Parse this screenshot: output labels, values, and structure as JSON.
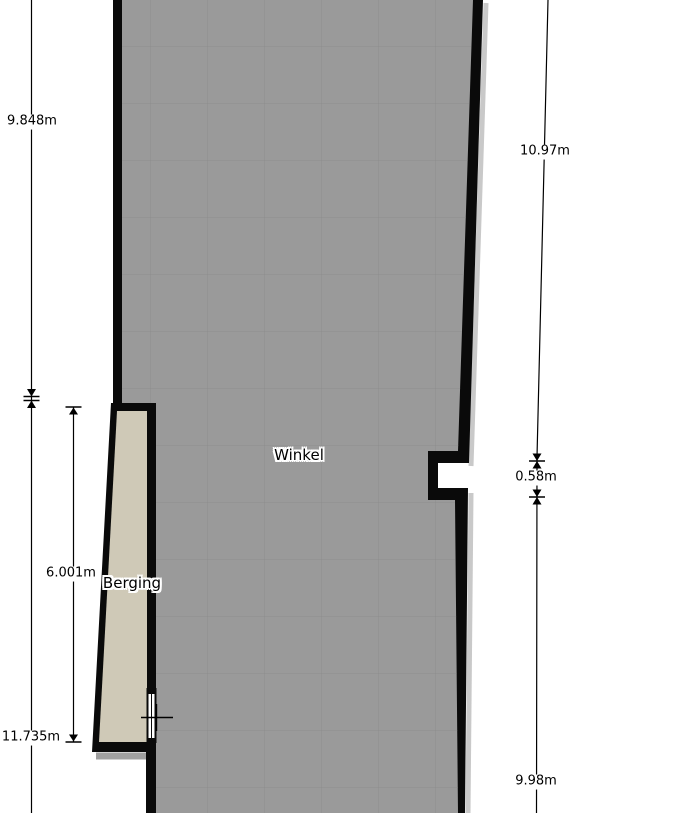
{
  "rooms": {
    "winkel": {
      "label": "Winkel"
    },
    "berging": {
      "label": "Berging"
    }
  },
  "dimensions": {
    "left_upper": "9.848m",
    "left_lower": "11.735m",
    "berging_height": "6.001m",
    "right_upper": "10.97m",
    "notch_height": "0.58m",
    "right_lower": "9.98m"
  },
  "colors": {
    "background": "#ffffff",
    "wall": "#0a0a0a",
    "winkel_floor": "#9a9a9a",
    "grid_line": "#8d8d8d",
    "berging_floor": "#cfc9b7",
    "wall_shadow": "#c9c9c9",
    "berging_shadow": "#a0a0a0",
    "dimension_line": "#000000",
    "window_fill": "#ffffff"
  }
}
